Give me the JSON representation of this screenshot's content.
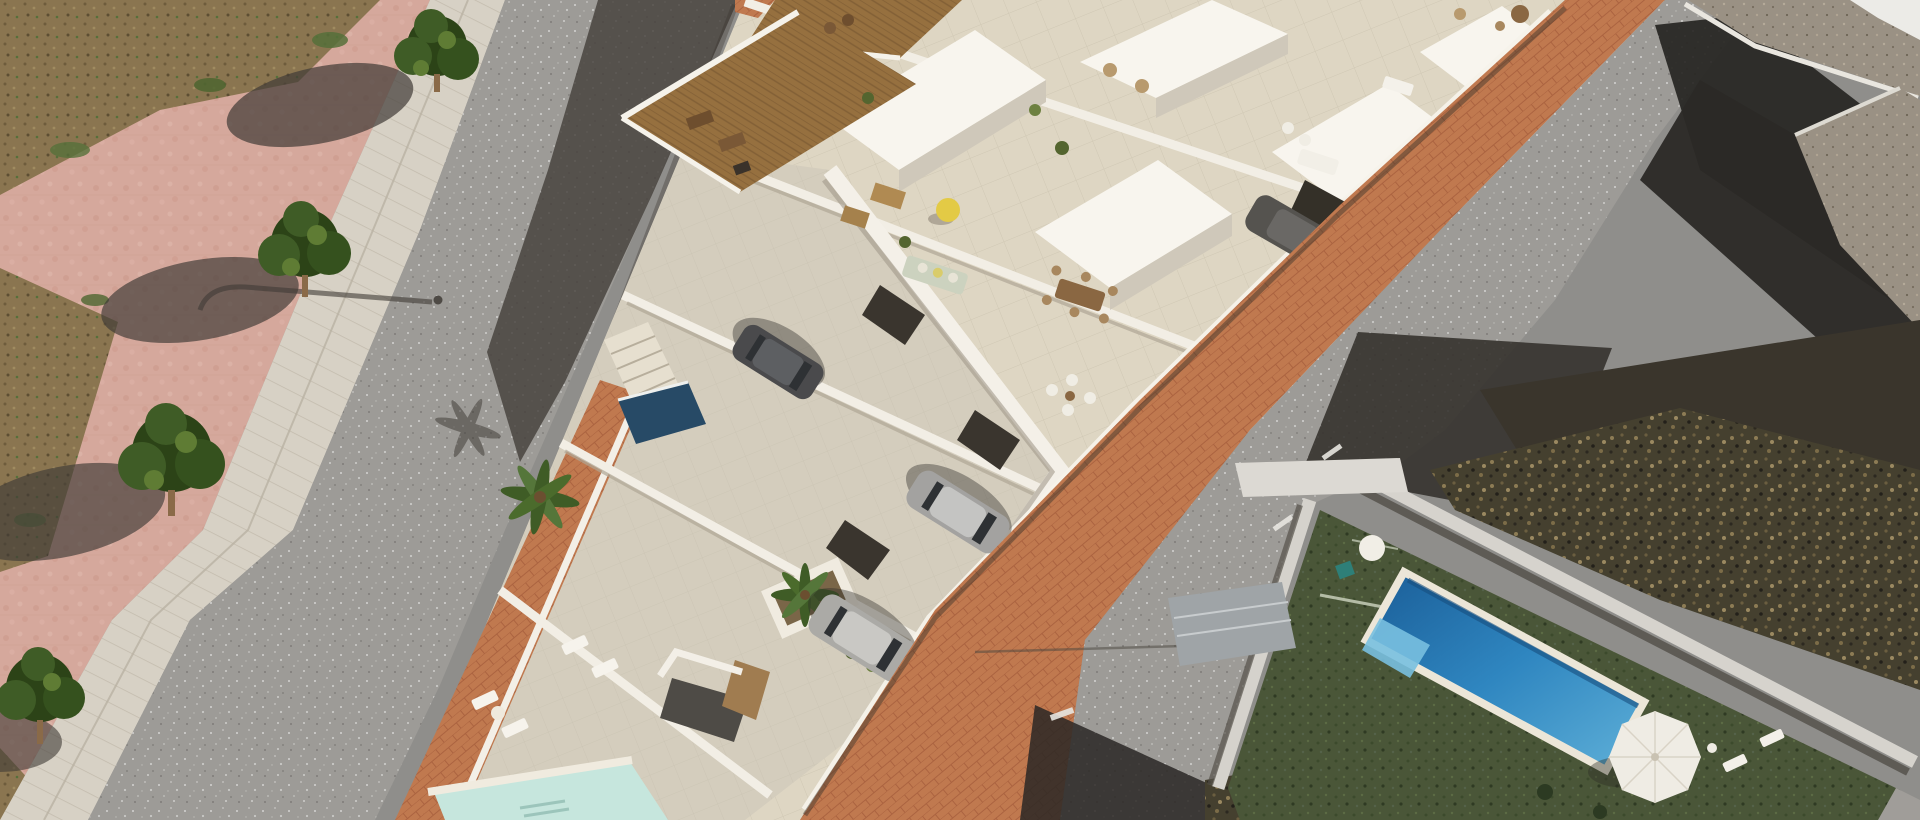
{
  "scene": {
    "type": "aerial architectural render photograph",
    "description": "Bird's-eye 3D visualisation of a row of new-build white Mediterranean townhouses with travertine roof terraces, wooden pergola decks, parked cars and a small plunge pool, set between a tree-lined pink pedestrian promenade with an asphalt street on the left and a terracotta brick sidewalk, second street and existing neighbouring houses with a deep blue pool, artificial turf lawn and white parasol on the right",
    "lighting": "bright midday sun, hard shadows cast toward the lower left",
    "palette": {
      "asphalt": "#8f8e8b",
      "asphalt_light": "#9d9b97",
      "road_shadow": "#35322d",
      "deep_shadow": "#24221f",
      "pink_pavement": "#d5a89c",
      "pink_mottle": "#c99687",
      "curb_stone": "#d7d1c5",
      "dirt": "#8a7550",
      "grass_tuft": "#55703a",
      "foliage_dark": "#2c4317",
      "foliage_mid": "#3f5c26",
      "foliage_light": "#5f7c34",
      "trunk": "#8a6a48",
      "dev_floor": "#ded6c3",
      "dev_floor_joint": "#cbc2ae",
      "street_concrete": "#d4cdbd",
      "wall_white": "#f6f3ec",
      "wall_shade": "#cfc8ba",
      "wall_dark": "#a2998a",
      "garage_dark": "#3a352e",
      "wood_deck": "#96703f",
      "wood_deck_dark": "#7d5c33",
      "brick": "#c0794f",
      "brick_joint": "#a65d3b",
      "car_dark": "#4a4a4c",
      "car_silver": "#a3a2a0",
      "car_glass": "#2e3134",
      "plunge_pool": "#274a66",
      "patio_pool": "#c6e6dd",
      "pool_deep": "#1a5d97",
      "pool_light": "#5fb0d8",
      "pool_shelf": "#79c0e0",
      "pool_coping": "#ece6d8",
      "turf": "#4a5638",
      "scrub_base": "#45402f",
      "scrub_light": "#8d7c55",
      "gravel": "#9a9184",
      "villa_wall": "#d6d3cd",
      "gate_metal": "#9fa4a7",
      "umbrella": "#efece4",
      "beanbag": "#e3ca45",
      "sofa_sage": "#ccd2bf",
      "furniture_wood": "#8a6742",
      "furniture_light": "#a8875e",
      "lounger_white": "#f6f3ec"
    },
    "left_promenade": {
      "pavement": "pink stone plaza",
      "street_trees": 4,
      "street_lamp": 1,
      "drain_channel": "light stone curb strip",
      "planting_beds": "dry earth with grass tufts"
    },
    "left_road": {
      "surface": "gray asphalt with light aggregate speckle",
      "shadow": "building shadow across upper half"
    },
    "development": {
      "style": "white modern terraced houses, render",
      "roof_decks_wood": 2,
      "roof_terraces": "beige travertine tile with white parapets and railings",
      "furniture": [
        "wooden dining set with chairs",
        "sage green lounge sofa with cushions",
        "yellow beanbag",
        "white lounge chair set",
        "white sun loungers",
        "outdoor kitchen barbecue",
        "brown mats",
        "white sofa",
        "round table"
      ],
      "plants": [
        "potted palm trees",
        "green shrubs",
        "planter boxes"
      ],
      "cars": [
        {
          "color": "dark gray",
          "location": "upper driveway"
        },
        {
          "color": "silver coupe",
          "location": "middle driveway"
        },
        {
          "color": "silver SUV",
          "location": "lower driveway"
        },
        {
          "color": "dark gray",
          "location": "right driveway"
        }
      ],
      "pools": [
        "small dark plunge pool",
        "pale turquoise patio pool at bottom edge"
      ],
      "palm_trees": 2,
      "staircase": "white external stairs"
    },
    "brick_sidewalk": {
      "material": "terracotta brick pavers in running bond"
    },
    "right_road": {
      "surface": "light gray asphalt",
      "details": [
        "large black building shadows",
        "overhead cable shadow line",
        "white curb stones"
      ]
    },
    "neighbours": {
      "existing_building": {
        "roof": "gravel flat roof with white parapet",
        "walls": "gray concrete"
      },
      "villa_plot": {
        "pool": "deep blue rectangular pool with pale tanning shelf",
        "lawn": "dark green artificial turf",
        "umbrella": "white parasol",
        "sun_loungers": 2,
        "boundary_wall": "light concrete wall",
        "gate": "metal driveway gate",
        "vegetation": "dry scrub and bare soil"
      }
    }
  }
}
